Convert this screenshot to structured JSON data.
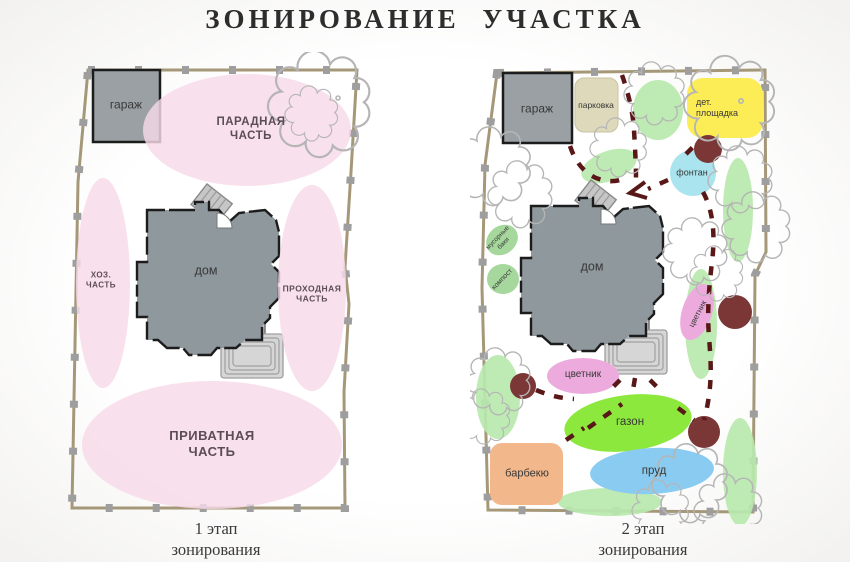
{
  "title": "ЗОНИРОВАНИЕ  УЧАСТКА",
  "plans": {
    "stage1": {
      "caption": "1 этап\nзонирования",
      "zones": {
        "garage": "гараж",
        "front": "ПАРАДНАЯ\nЧАСТЬ",
        "utility": "ХОЗ.\nЧАСТЬ",
        "house": "дом",
        "passage": "ПРОХОДНАЯ\nЧАСТЬ",
        "private": "ПРИВАТНАЯ\nЧАСТЬ"
      }
    },
    "stage2": {
      "caption": "2 этап\nзонирования",
      "zones": {
        "garage": "гараж",
        "parking": "парковка",
        "playground": "дет.\nплощадка",
        "fountain": "фонтан",
        "trash_bins": "мусорные\nбаки",
        "compost": "компост",
        "house": "дом",
        "flowerbed_side": "цветник",
        "flowerbed_front": "цветник",
        "lawn": "газон",
        "pond": "пруд",
        "bbq": "барбекю"
      }
    }
  },
  "colors": {
    "zone_pink": "#f7d9e8",
    "house_gray": "#8f989d",
    "house_stroke": "#1c1c1c",
    "garage_gray": "#9aa0a4",
    "parking_beige": "#ded9ba",
    "playground_yellow": "#fcec55",
    "fountain_cyan": "#a9e4ef",
    "tree_maroon": "#7b3636",
    "bush_green": "#b9e8ae",
    "compost_green": "#a6d79c",
    "flower_pink": "#edabdd",
    "lawn_green": "#8ce83c",
    "pond_blue": "#8accf1",
    "bbq_orange": "#f3b78c",
    "path_red": "#5a1717",
    "fence_tan": "#a59878",
    "post_gray": "#9e9e9e",
    "cloud_gray": "#b5b5b5",
    "terrace_gray": "#d6d6d6"
  }
}
